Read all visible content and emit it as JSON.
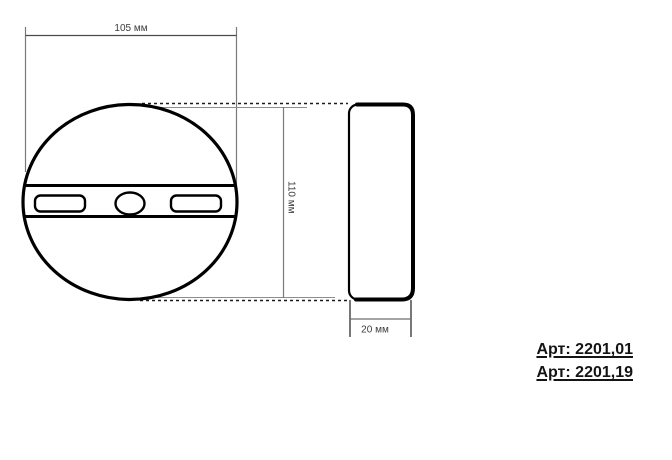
{
  "drawing": {
    "type": "technical-dimension-drawing",
    "front_view": {
      "shape": "circle-with-mounting-band",
      "width_mm": 105,
      "height_mm": 110,
      "width_label": "105 мм",
      "height_label": "110 мм",
      "features": [
        "left-slot",
        "center-hole",
        "right-slot"
      ]
    },
    "side_view": {
      "shape": "rounded-profile",
      "depth_mm": 20,
      "depth_label": "20 мм"
    },
    "articles": [
      "Арт: 2201,01",
      "Арт: 2201,19"
    ],
    "colors": {
      "outline": "#000000",
      "dimension_line": "#6e6e6e",
      "dimension_text": "#3c3c3c",
      "article_text": "#141414",
      "background": "#ffffff"
    }
  }
}
